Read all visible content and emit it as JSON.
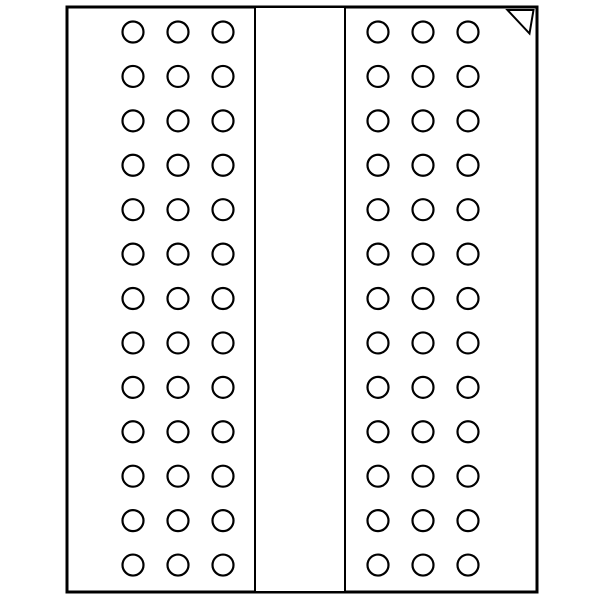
{
  "diagram": {
    "kind": "bga-package-ball-grid",
    "canvas": {
      "width": 600,
      "height": 600,
      "background_color": "#ffffff"
    },
    "colors": {
      "stroke": "#000000",
      "fill": "#ffffff"
    },
    "package_outline": {
      "x": 67,
      "y": 7,
      "width": 470,
      "height": 585,
      "stroke_width": 3
    },
    "center_channel": {
      "x": 255,
      "y": 7,
      "width": 90,
      "height": 585,
      "stroke_width": 2
    },
    "ball": {
      "radius": 10.5,
      "stroke_width": 2.2,
      "fill": "#ffffff"
    },
    "grid": {
      "row_count": 13,
      "row_start_y": 32,
      "row_spacing": 44.42,
      "left_block_column_x": [
        133,
        178,
        223
      ],
      "right_block_column_x": [
        378,
        423,
        468
      ],
      "ball_count_total": 78
    },
    "pin1_marker": {
      "points": "507.5,10 533.5,10 529.5,33.5",
      "stroke_width": 2,
      "fill": "#ffffff"
    }
  }
}
